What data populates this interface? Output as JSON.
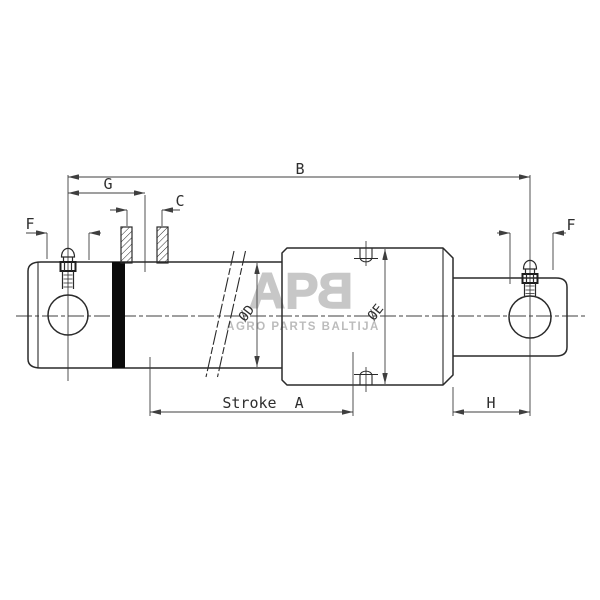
{
  "drawing": {
    "title_hint": "hydraulic plunger cylinder dimensional drawing",
    "labels": {
      "b": "B",
      "g": "G",
      "c": "C",
      "f_left": "F",
      "f_right": "F",
      "stroke_a": "Stroke  A",
      "h": "H",
      "dia_d": "ØD",
      "dia_e": "ØE"
    }
  },
  "watermark": {
    "logo_ap": "AP",
    "logo_b_mirrored": "B",
    "tagline": "AGRO PARTS BALTIJA"
  },
  "colors": {
    "background": "#ffffff",
    "outline": "#2a2a2a",
    "thin_line": "#3f3f3f",
    "label_text": "#2e2e2e",
    "piston_band": "#0b0b0b",
    "watermark_logo": "#c7c7c7",
    "watermark_tagline": "#bcbcbc"
  }
}
